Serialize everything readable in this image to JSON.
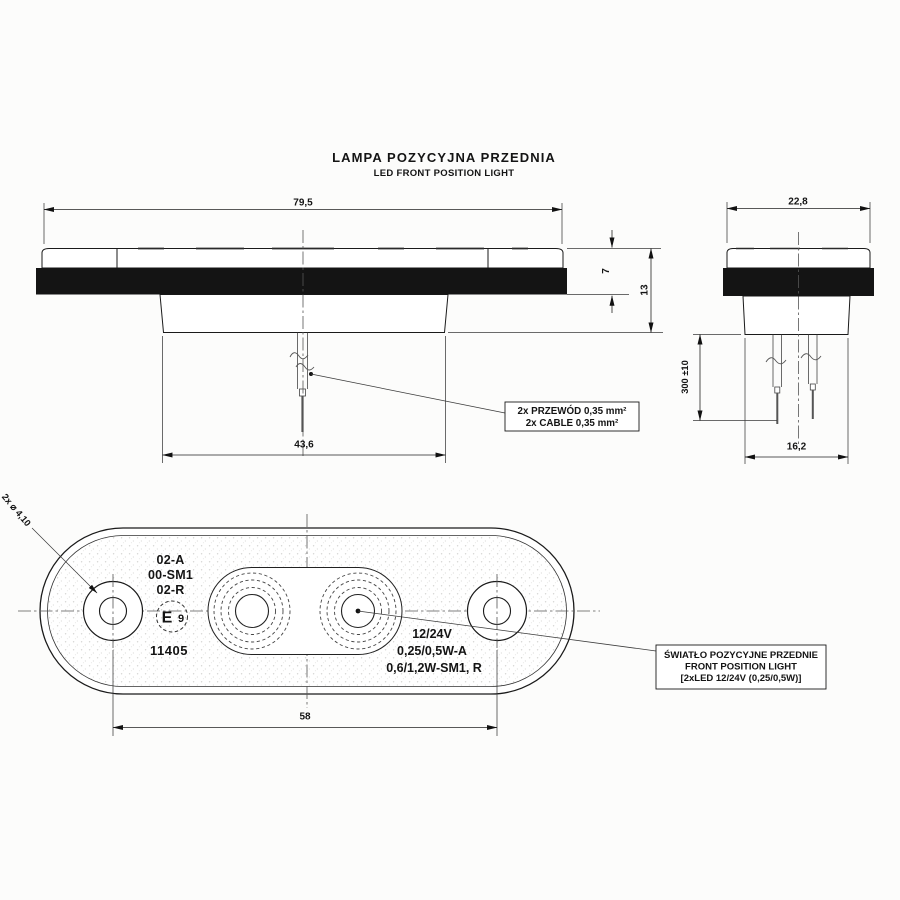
{
  "title": {
    "primary": "LAMPA POZYCYJNA PRZEDNIA",
    "secondary": "LED FRONT POSITION LIGHT"
  },
  "side_view": {
    "width": "79,5",
    "lens_height": "7",
    "total_height": "13",
    "base_width": "43,6"
  },
  "end_view": {
    "width": "22,8",
    "cable_length": "300 ±10",
    "base_width": "16,2"
  },
  "front_view": {
    "hole_note": "2x ⌀ 4,10",
    "hole_spacing": "58",
    "marking_line1": "02-A",
    "marking_line2": "00-SM1",
    "marking_line3": "02-R",
    "approval_letter": "E",
    "approval_number": "9",
    "part_number": "11405",
    "voltage": "12/24V",
    "power_line1": "0,25/0,5W-A",
    "power_line2": "0,6/1,2W-SM1, R"
  },
  "callouts": {
    "cable_line1": "2x PRZEWÓD 0,35 mm²",
    "cable_line2": "2x CABLE 0,35 mm²",
    "function_line1": "ŚWIATŁO POZYCYJNE PRZEDNIE",
    "function_line2": "FRONT POSITION LIGHT",
    "function_line3": "[2xLED 12/24V (0,25/0,5W)]"
  },
  "colors": {
    "line": "#1a1a1a",
    "body_band": "#141414",
    "background": "#fcfcfb"
  }
}
